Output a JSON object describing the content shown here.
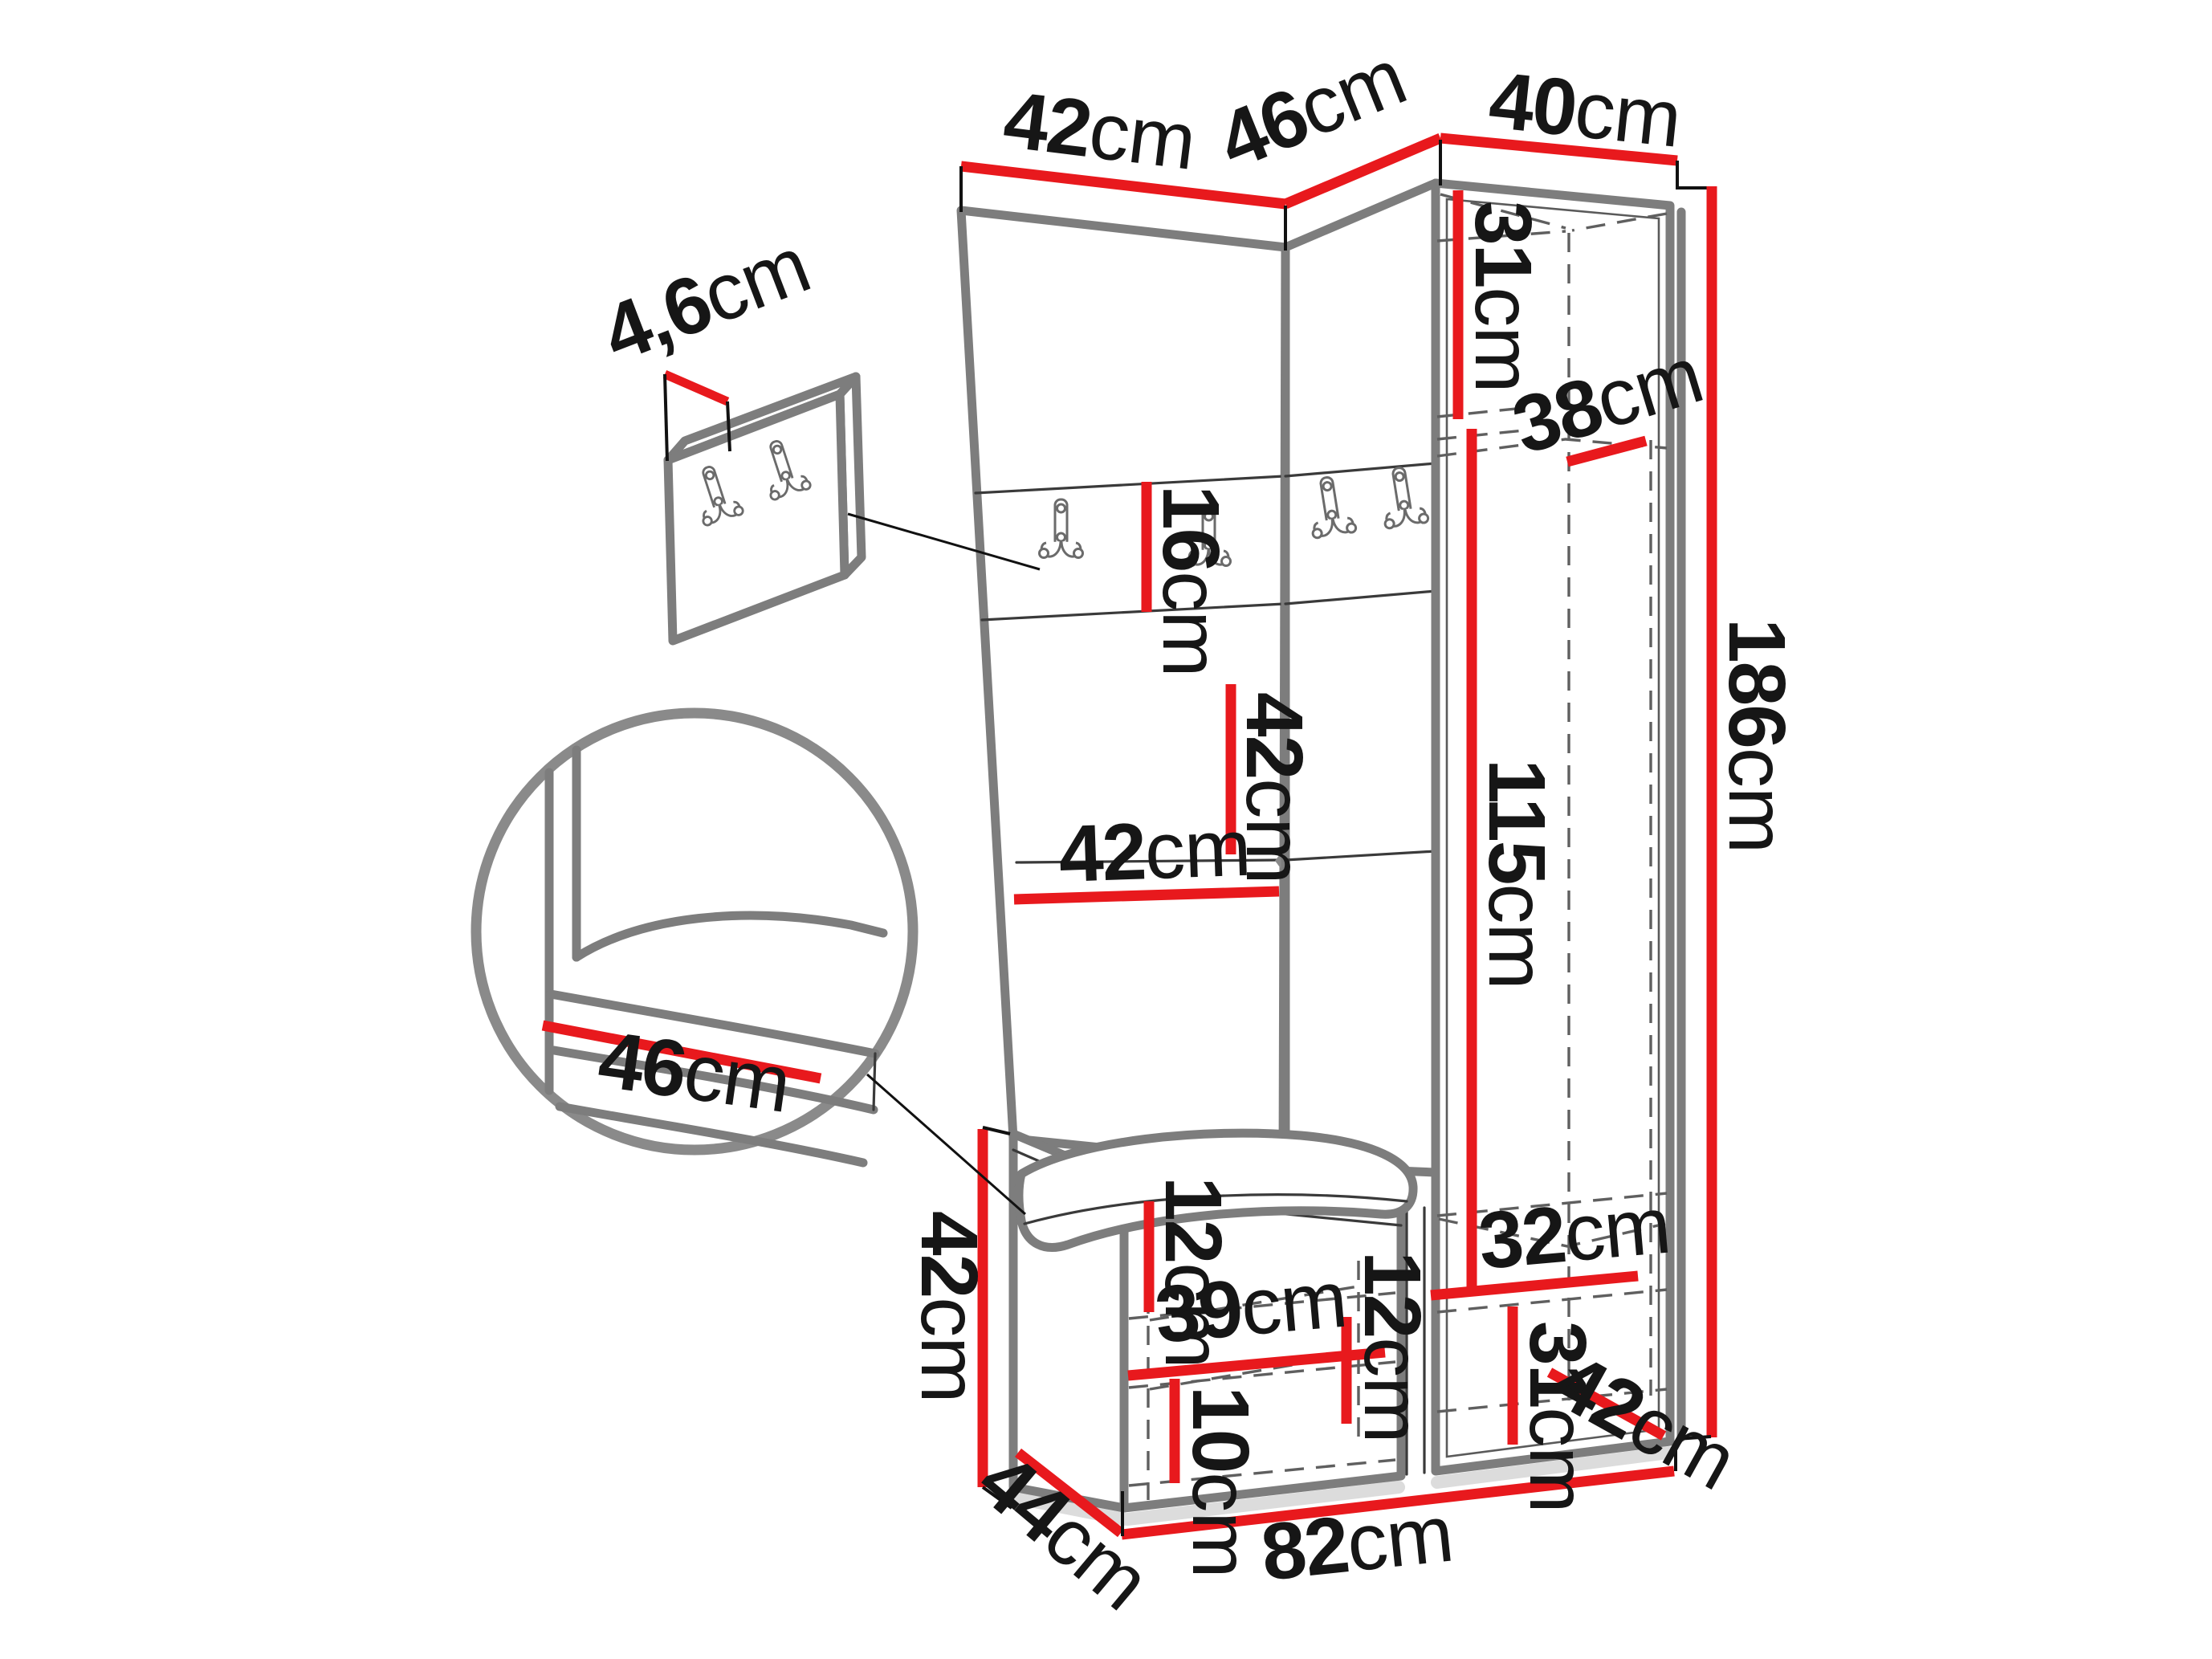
{
  "diagram": {
    "type": "furniture-dimension-drawing",
    "subject": "corner hallway wardrobe set with coat hooks, bench and tall cabinet",
    "unit": "cm",
    "colors": {
      "dimension_line": "#e8191d",
      "outline": "#7d7d7d",
      "hidden_edge": "#5f5f5f",
      "text": "#161616",
      "background": "#ffffff"
    },
    "icons": {
      "hook": "double-coat-hook-icon"
    },
    "dimensions": {
      "top_left_width": {
        "value": "42",
        "unit": "cm"
      },
      "corner_width": {
        "value": "46",
        "unit": "cm"
      },
      "cabinet_width": {
        "value": "40",
        "unit": "cm"
      },
      "panel_thickness": {
        "value": "4,6",
        "unit": "cm"
      },
      "hook_strip_height": {
        "value": "16",
        "unit": "cm"
      },
      "upper_section_height": {
        "value": "31",
        "unit": "cm"
      },
      "cabinet_inner_depth": {
        "value": "38",
        "unit": "cm"
      },
      "mid_panel_height": {
        "value": "42",
        "unit": "cm"
      },
      "mid_panel_width": {
        "value": "42",
        "unit": "cm"
      },
      "hanging_height": {
        "value": "115",
        "unit": "cm"
      },
      "total_height": {
        "value": "186",
        "unit": "cm"
      },
      "seat_detail_depth": {
        "value": "46",
        "unit": "cm"
      },
      "bench_height": {
        "value": "42",
        "unit": "cm"
      },
      "bench_top_clearance": {
        "value": "12",
        "unit": "cm"
      },
      "bench_shelf_width": {
        "value": "39",
        "unit": "cm"
      },
      "corner_clearance": {
        "value": "12",
        "unit": "cm"
      },
      "plinth_height": {
        "value": "10",
        "unit": "cm"
      },
      "bench_depth": {
        "value": "44",
        "unit": "cm"
      },
      "base_width": {
        "value": "82",
        "unit": "cm"
      },
      "lower_shelf_width": {
        "value": "32",
        "unit": "cm"
      },
      "lower_section_height": {
        "value": "31",
        "unit": "cm"
      },
      "cabinet_depth": {
        "value": "42",
        "unit": "cm"
      }
    }
  }
}
